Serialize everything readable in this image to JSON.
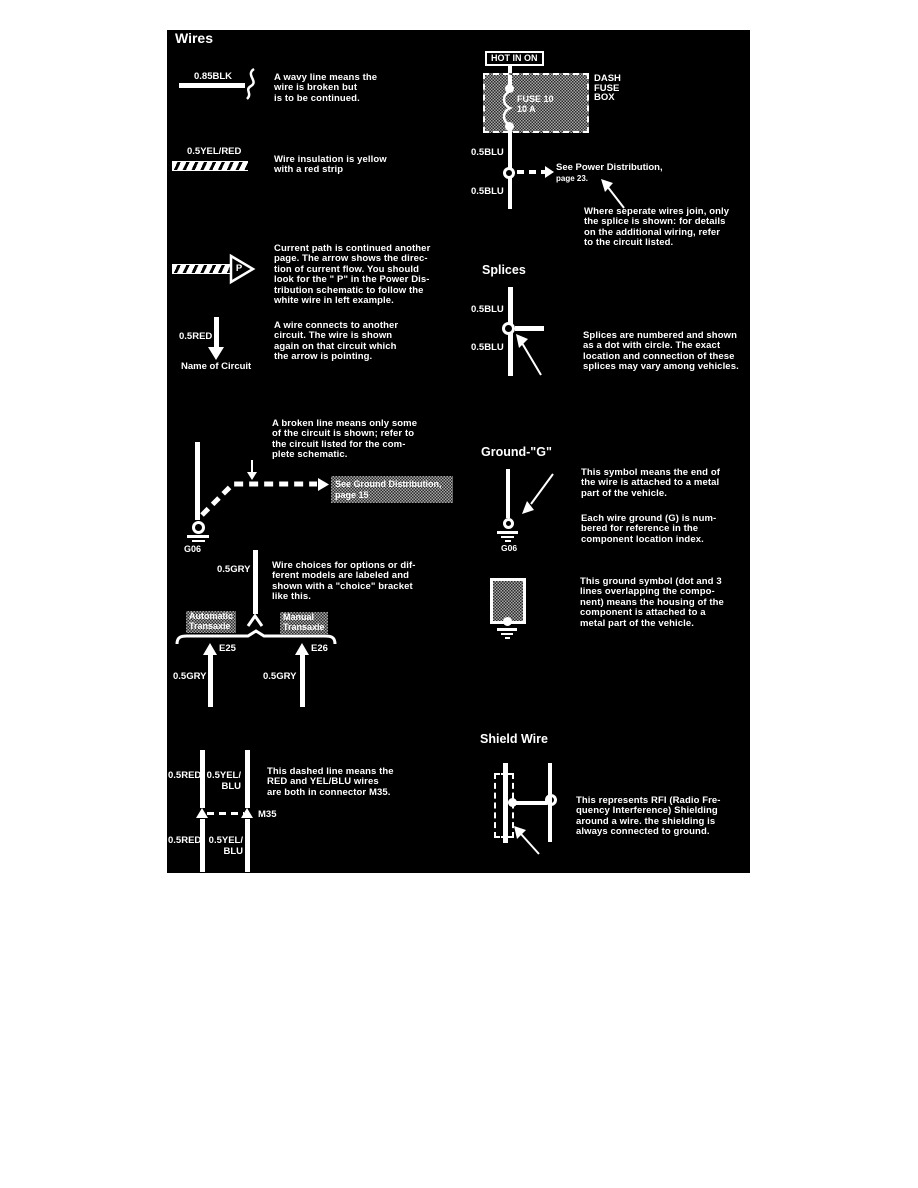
{
  "colors": {
    "panel_bg": "#000000",
    "ink": "#ffffff",
    "page_bg": "#ffffff"
  },
  "panel": {
    "title": "Wires",
    "left": {
      "wavy": {
        "label": "0.85BLK",
        "desc": "A wavy line means the\nwire is broken but\nis to be continued."
      },
      "insulation": {
        "label": "0.5YEL/RED",
        "desc": "Wire insulation is yellow\nwith a red strip"
      },
      "current_path": {
        "p": "P",
        "desc": "Current path is continued another\npage. The arrow shows the direc-\ntion of current flow. You should\nlook for the \" P\" in the Power Dis-\ntribution schematic to follow the\nwhite wire in left example."
      },
      "connect": {
        "label": "0.5RED",
        "circuit": "Name of Circuit",
        "desc": "A wire connects to another\ncircuit. The wire is shown\nagain on that circuit which\nthe arrow is pointing."
      },
      "broken": {
        "desc": "A broken line means only some\nof the circuit is shown; refer to\nthe circuit listed for the com-\nplete schematic.",
        "ref": "See Ground Distribution,\npage 15",
        "ground": "G06"
      },
      "choice": {
        "top_label": "0.5GRY",
        "desc": "Wire choices for options or dif-\nferent models are labeled and\nshown with a \"choice\" bracket\nlike this.",
        "opt1": "Automatic\nTransaxle",
        "opt2": "Manual\nTransaxle",
        "e25": "E25",
        "e26": "E26",
        "left_label": "0.5GRY",
        "right_label": "0.5GRY"
      },
      "connector": {
        "red_top": "0.5RED",
        "yel_top": "0.5YEL/\nBLU",
        "red_bot": "0.5RED",
        "yel_bot": "0.5YEL/\nBLU",
        "name": "M35",
        "desc": "This dashed line means the\nRED and YEL/BLU wires\nare both in connector M35."
      }
    },
    "right": {
      "hot": "HOT IN ON",
      "fuse": {
        "label": "FUSE 10\n10 A",
        "box": "DASH\nFUSE\nBOX",
        "wire_top": "0.5BLU",
        "wire_bot": "0.5BLU",
        "ref": "See Power Distribution,",
        "ref2": "page 23.",
        "desc": "Where seperate wires join, only\nthe splice is shown: for details\non the additional wiring, refer\nto the circuit listed."
      },
      "splices": {
        "heading": "Splices",
        "wire_top": "0.5BLU",
        "wire_bot": "0.5BLU",
        "desc": "Splices are numbered and shown\nas a dot with circle. The exact\nlocation and connection of these\nsplices may vary among vehicles."
      },
      "ground": {
        "heading": "Ground-\"G\"",
        "label": "G06",
        "desc1": "This symbol means the end of\nthe wire is attached to a metal\npart of the vehicle.",
        "desc2": "Each wire ground (G) is num-\nbered for reference in the\ncomponent location index."
      },
      "ground2": {
        "desc": "This ground symbol (dot and 3\nlines overlapping the compo-\nnent) means the housing of the\ncomponent is attached to a\nmetal part of the vehicle."
      },
      "shield": {
        "heading": "Shield Wire",
        "desc": "This represents RFI (Radio Fre-\nquency Interference) Shielding\naround a wire. the shielding is\nalways connected to ground."
      }
    }
  }
}
